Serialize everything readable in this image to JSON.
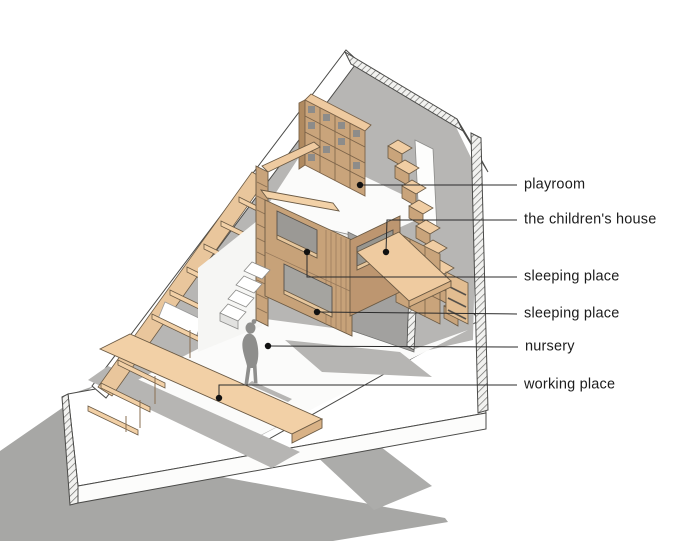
{
  "meta": {
    "width": 700,
    "height": 541,
    "background": "#ffffff",
    "drawing_type": "axonometric cutaway section of a children's attic room"
  },
  "palette": {
    "wood_light": "#f2d0a6",
    "wood_mid": "#c9a47b",
    "wood_dark": "#b08a60",
    "facade_tan": "#c7a279",
    "wall_gray": "#b7b6b4",
    "wall_dark_gray": "#a2a19f",
    "window_gray": "#9b9995",
    "floor_white": "#fbfbfa",
    "ground_shadow": "#a7a7a5",
    "floor_shadow": "#b6b5b3",
    "line": "#2b2b2b",
    "text": "#1c1c1c"
  },
  "scene": {
    "elements": [
      "sloped-roof",
      "ridge-cut-band",
      "left-shelving",
      "children-house",
      "right-staircase",
      "mezzanine-platform",
      "cube-shelf",
      "work-desk",
      "child-figure",
      "floor-slab",
      "cast-shadow"
    ]
  },
  "annotations": [
    {
      "id": "playroom",
      "label": "playroom",
      "dot": [
        360,
        185
      ],
      "path": [
        [
          360,
          185
        ],
        [
          517,
          185
        ]
      ],
      "label_pos": [
        524,
        185
      ]
    },
    {
      "id": "childrens-house",
      "label": "the children's house",
      "dot": [
        386,
        252
      ],
      "path": [
        [
          386,
          252
        ],
        [
          387,
          220
        ],
        [
          517,
          220
        ]
      ],
      "label_pos": [
        524,
        220
      ]
    },
    {
      "id": "sleeping-1",
      "label": "sleeping place",
      "dot": [
        307,
        252
      ],
      "path": [
        [
          307,
          252
        ],
        [
          307,
          277
        ],
        [
          517,
          277
        ]
      ],
      "label_pos": [
        524,
        277
      ]
    },
    {
      "id": "sleeping-2",
      "label": "sleeping place",
      "dot": [
        317,
        312
      ],
      "path": [
        [
          317,
          312
        ],
        [
          517,
          314
        ]
      ],
      "label_pos": [
        524,
        314
      ]
    },
    {
      "id": "nursery",
      "label": "nursery",
      "dot": [
        268,
        346
      ],
      "path": [
        [
          268,
          346
        ],
        [
          518,
          347
        ]
      ],
      "label_pos": [
        525,
        347
      ]
    },
    {
      "id": "working-place",
      "label": "working place",
      "dot": [
        219,
        398
      ],
      "path": [
        [
          219,
          398
        ],
        [
          219,
          385
        ],
        [
          517,
          385
        ]
      ],
      "label_pos": [
        524,
        385
      ]
    }
  ]
}
